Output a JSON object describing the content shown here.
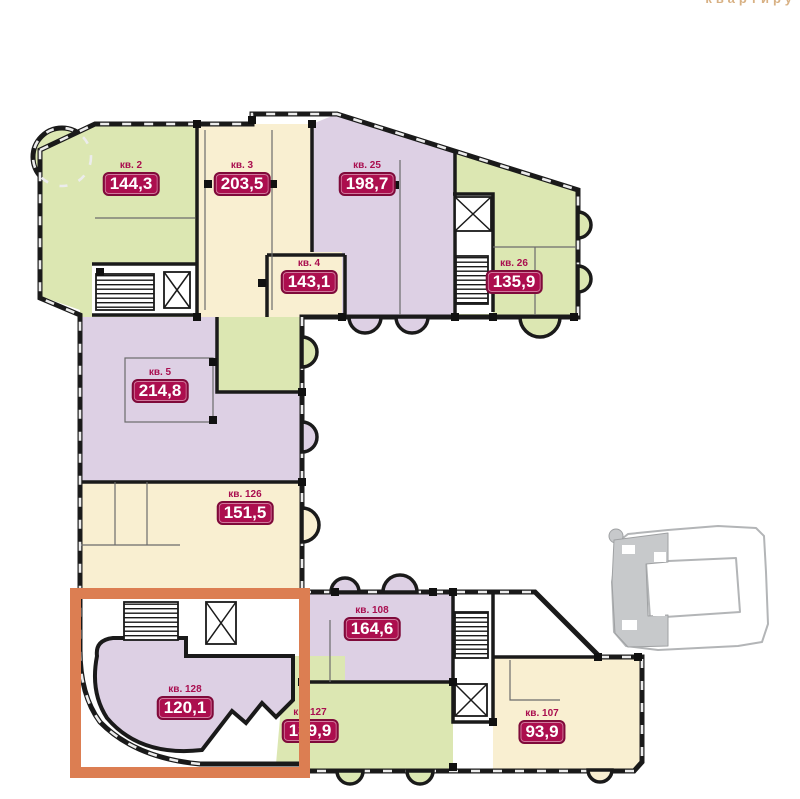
{
  "page": {
    "clipped_header_text": "квартиру",
    "background_color": "#ffffff"
  },
  "floorplan": {
    "unit_label_prefix": "кв.",
    "colors": {
      "wall": "#1a1a1a",
      "green_unit": "#dce7b2",
      "cream_unit": "#f9efd1",
      "purple_unit": "#ddd0e4",
      "badge_bg": "#ac0e4e",
      "badge_border": "#7f0a3a",
      "badge_text": "#ffffff",
      "highlight_box": "#dc7e52"
    },
    "apartments": [
      {
        "label": "кв. 2",
        "area": "144,3",
        "color": "green"
      },
      {
        "label": "кв. 3",
        "area": "203,5",
        "color": "cream"
      },
      {
        "label": "кв. 25",
        "area": "198,7",
        "color": "purple"
      },
      {
        "label": "кв. 4",
        "area": "143,1",
        "color": "cream"
      },
      {
        "label": "кв. 26",
        "area": "135,9",
        "color": "green"
      },
      {
        "label": "кв. 5",
        "area": "214,8",
        "color": "purple"
      },
      {
        "label": "кв. 126",
        "area": "151,5",
        "color": "cream"
      },
      {
        "label": "кв. 108",
        "area": "164,6",
        "color": "purple"
      },
      {
        "label": "кв. 128",
        "area": "120,1",
        "color": "purple"
      },
      {
        "label": "кв. 127",
        "area": "139,9",
        "color": "green"
      },
      {
        "label": "кв. 107",
        "area": "93,9",
        "color": "cream"
      }
    ],
    "highlighted_unit": "кв. 128"
  },
  "minimap": {
    "highlighted_section": "left-wing"
  }
}
